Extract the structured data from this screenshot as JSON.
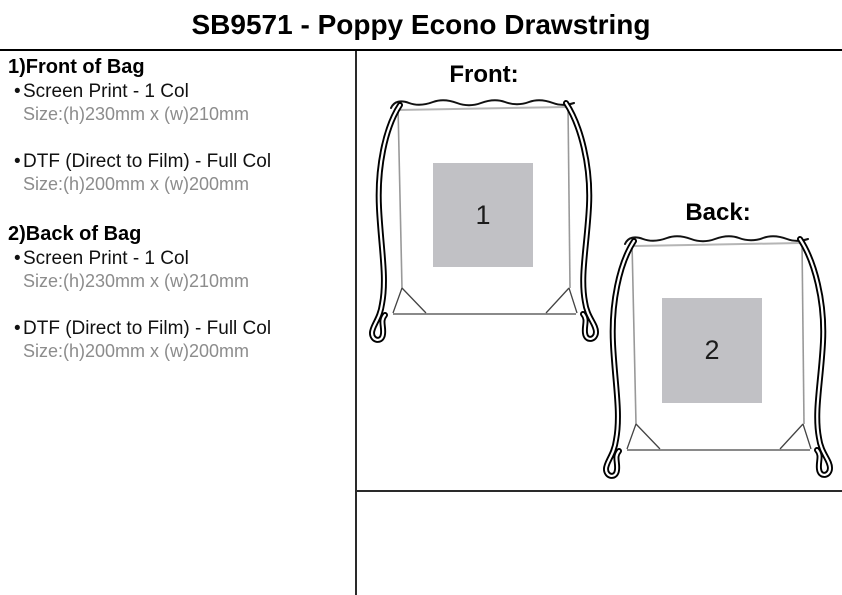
{
  "title": "SB9571 - Poppy Econo Drawstring",
  "bullet": "•",
  "sections": [
    {
      "heading": "1)Front of Bag",
      "items": [
        {
          "label": "Screen Print - 1 Col",
          "size": "Size:(h)230mm x (w)210mm"
        },
        {
          "label": "DTF (Direct to Film) - Full Col",
          "size": "Size:(h)200mm x (w)200mm"
        }
      ]
    },
    {
      "heading": "2)Back of Bag",
      "items": [
        {
          "label": "Screen Print - 1 Col",
          "size": "Size:(h)230mm x (w)210mm"
        },
        {
          "label": "DTF (Direct to Film) - Full Col",
          "size": "Size:(h)200mm x (w)200mm"
        }
      ]
    }
  ],
  "diagrams": [
    {
      "label": "Front:",
      "print_area_number": "1"
    },
    {
      "label": "Back:",
      "print_area_number": "2"
    }
  ],
  "colors": {
    "print_area_fill": "#c1c1c5",
    "size_text": "#8c8c8c",
    "line": "#000000"
  }
}
